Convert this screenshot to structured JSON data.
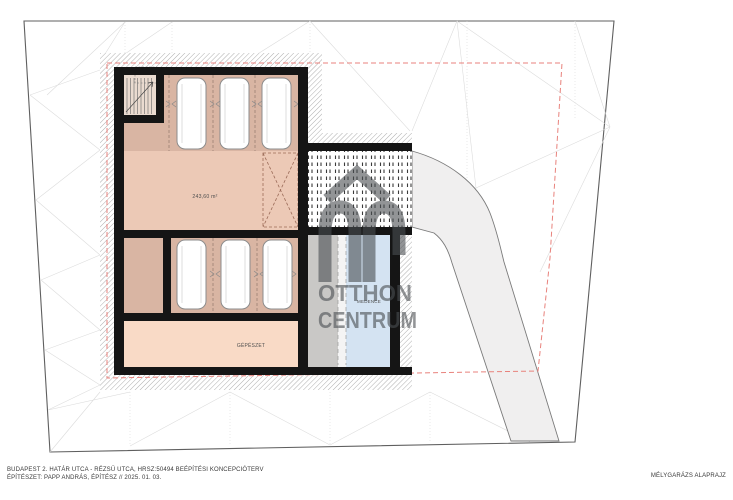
{
  "title_block": {
    "project_line": "BUDAPEST 2. HATÁR UTCA - RÉZSŰ UTCA, HRSZ:50494 BEÉPÍTÉSI KONCEPCIÓTERV",
    "architect_line": "ÉPÍTÉSZET: PAPP ANDRÁS, ÉPÍTÉSZ // 2025. 01. 03.",
    "drawing_title": "MÉLYGARÁZS ALAPRAJZ"
  },
  "plan": {
    "garage_area_label": "243,60 m²",
    "room_labels": {
      "mechanical": "GÉPÉSZET",
      "pool": "MEDENCE"
    },
    "parking_space_count": 6
  },
  "watermark": {
    "logo": "otthon-centrum-oc-monogram",
    "brand_line1": "OTTHON",
    "brand_line2": "CENTRUM"
  },
  "colors": {
    "floor_dark": "#d9b5a3",
    "floor_light": "#ecc9b6",
    "floor_mechanical": "#f9dac6",
    "stair_floor": "#eadbd0",
    "pool_deck_gray": "#c9c8c6",
    "pool_blue": "#d4e3f2",
    "wall_black": "#151515",
    "setback_red": "#e8827c",
    "watermark_gray": "#4a4e52",
    "driveway_gray": "#f0efef"
  }
}
